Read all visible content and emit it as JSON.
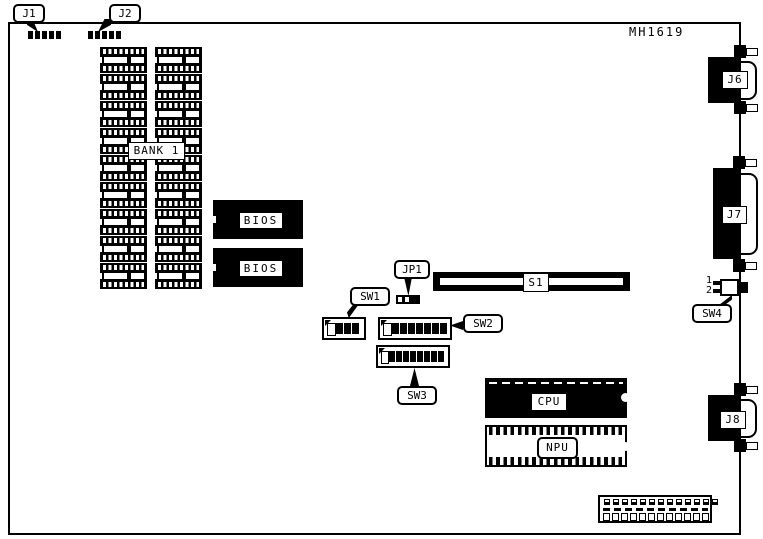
{
  "title": {
    "part_number": "MH1619"
  },
  "callouts": {
    "j1": "J1",
    "j2": "J2",
    "jp1": "JP1",
    "sw1": "SW1",
    "sw2": "SW2",
    "sw3": "SW3",
    "sw4": "SW4"
  },
  "components": {
    "bank1": "BANK 1",
    "bios1": "BIOS",
    "bios2": "BIOS",
    "s1": "S1",
    "cpu": "CPU",
    "npu": "NPU",
    "j6": "J6",
    "j7": "J7",
    "j8": "J8"
  },
  "sw4_pins": {
    "pin1": "1",
    "pin2": "2"
  },
  "memory_bank": {
    "columns": 2,
    "rows": 9
  },
  "switches": {
    "sw1": {
      "cells_off": 1,
      "cells_on": 3
    },
    "sw2": {
      "cells_off": 1,
      "cells_on": 7
    },
    "sw3": {
      "cells_off": 1,
      "cells_on": 8
    }
  },
  "jumper_jp1": {
    "open_pins": 2,
    "capped": 1
  },
  "edge_connector": {
    "top_contacts": 13,
    "bottom_contacts": 12
  }
}
